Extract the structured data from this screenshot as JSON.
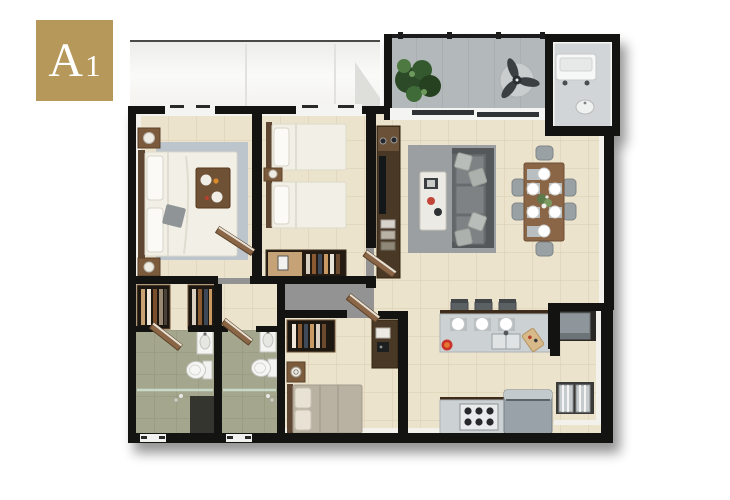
{
  "unit_badge": {
    "letter": "A",
    "number": "1"
  },
  "colors": {
    "badge-bg": "#b6985a",
    "badge-text": "#ffffff",
    "wall": "#131312",
    "floor": "#ece3cd",
    "grout": "#ddd2b6",
    "bath-floor": "#a5a68e",
    "bath-grout": "#93947c",
    "balcony-floor": "#b3b8ba",
    "rug-living": "#9b9fa1",
    "rug-bedroom": "#bcc5cc",
    "sofa": "#63676a",
    "wood": "#8a6647",
    "dark-wood": "#4a3826",
    "counter": "#ccd1d3",
    "appliance": "#99a2a8",
    "white-furn": "#f4f4f2",
    "plant": "#32512e",
    "accent-red": "#c8342a"
  },
  "plan": {
    "unit": "A1",
    "rooms": [
      {
        "name": "master-bedroom",
        "furniture": [
          "double-bed",
          "breakfast-tray",
          "area-rug",
          "nightstand-with-lamp",
          "nightstand-with-lamp",
          "wardrobes"
        ]
      },
      {
        "name": "bedroom-2",
        "furniture": [
          "twin-bed",
          "twin-bed",
          "nightstand-with-lamp",
          "wardrobe-with-clothes"
        ]
      },
      {
        "name": "bedroom-3",
        "furniture": [
          "single-bed",
          "nightstand-with-clock",
          "closet-with-clothes",
          "desk"
        ]
      },
      {
        "name": "bathroom-1",
        "furniture": [
          "toilet",
          "vanity-sink",
          "glass-shower"
        ]
      },
      {
        "name": "bathroom-2",
        "furniture": [
          "toilet",
          "vanity-sink",
          "glass-shower"
        ]
      },
      {
        "name": "hallway",
        "furniture": [
          "tv-console"
        ]
      },
      {
        "name": "living-room",
        "furniture": [
          "sofa-with-pillows",
          "coffee-table",
          "gray-rug"
        ]
      },
      {
        "name": "dining-area",
        "furniture": [
          "dining-table",
          "six-chairs",
          "place-settings",
          "centerpiece-flowers"
        ]
      },
      {
        "name": "kitchen",
        "furniture": [
          "breakfast-bar",
          "three-stools",
          "double-sink",
          "cutting-board",
          "red-pot",
          "gas-stove",
          "refrigerator"
        ]
      },
      {
        "name": "utility-niche",
        "furniture": [
          "wall-unit",
          "towel-shelf"
        ]
      },
      {
        "name": "balcony",
        "furniture": [
          "potted-plant",
          "ceiling-fan",
          "railing"
        ]
      },
      {
        "name": "laundry-room",
        "furniture": [
          "washing-machine",
          "utility-sink"
        ]
      }
    ]
  }
}
